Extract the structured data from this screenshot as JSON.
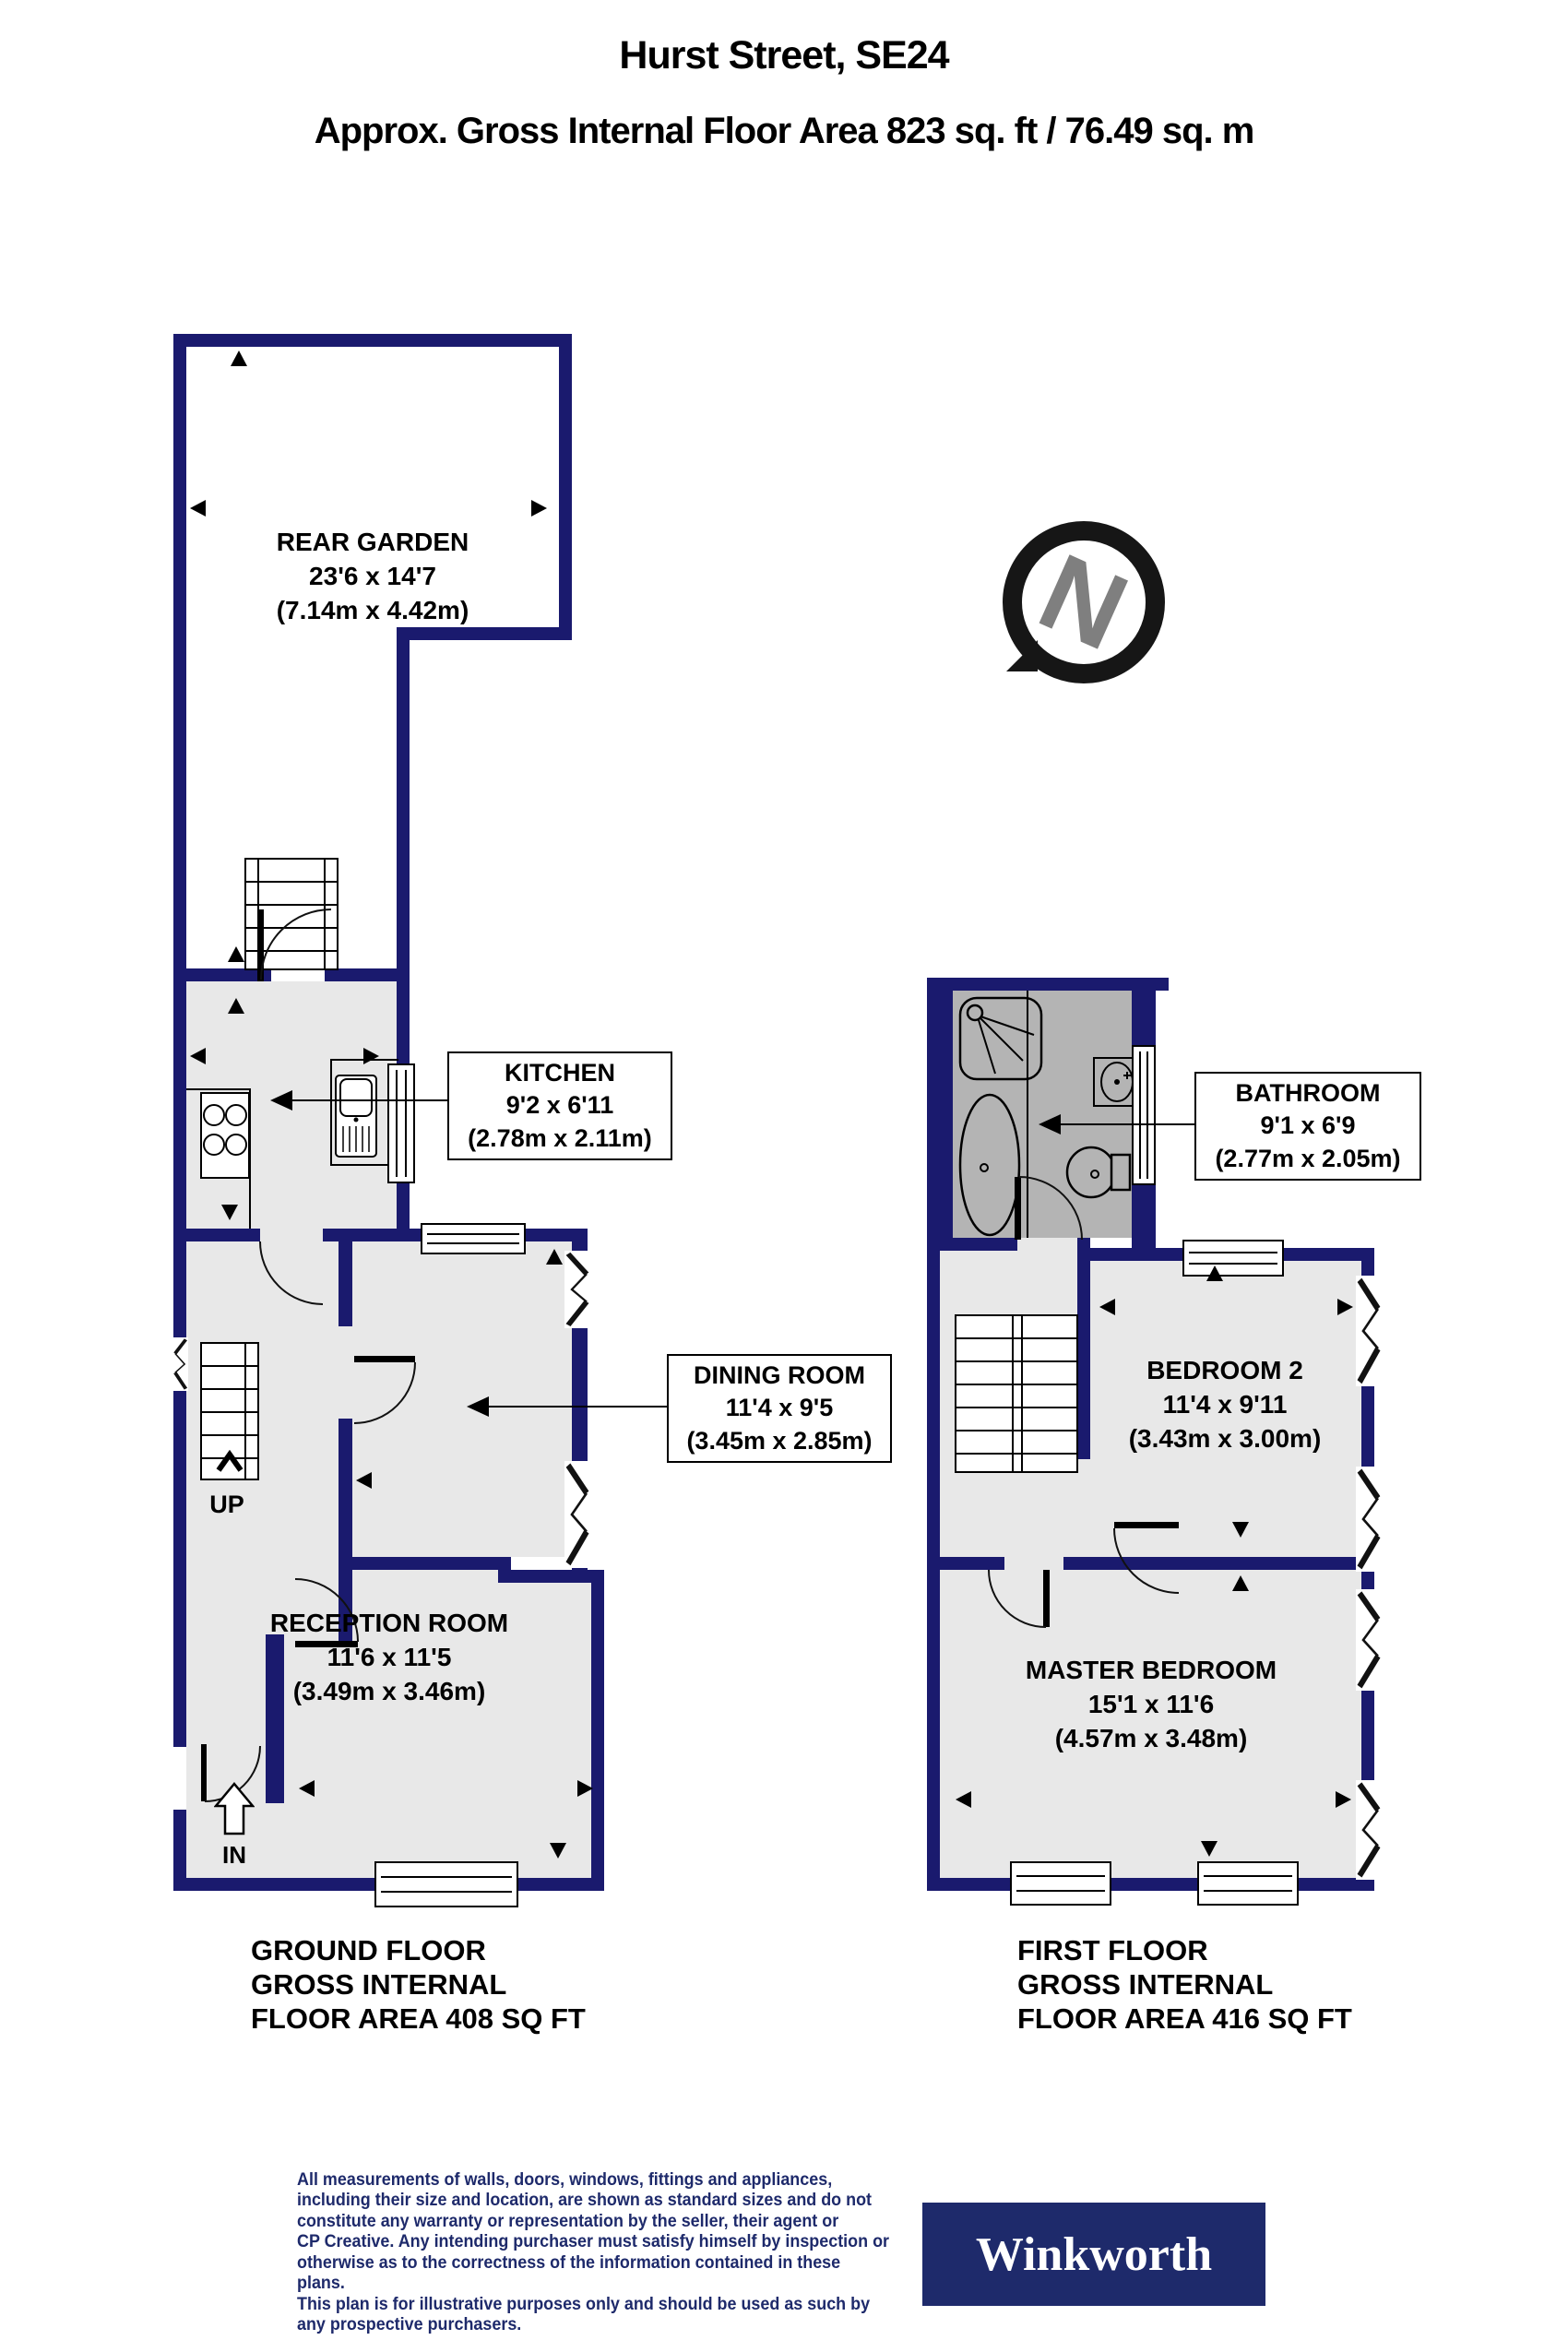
{
  "header": {
    "title": "Hurst Street, SE24",
    "subtitle": "Approx. Gross Internal Floor Area 823 sq. ft / 76.49 sq. m"
  },
  "colors": {
    "wall_navy": "#1a1a6e",
    "floor_light_gray": "#e8e8e8",
    "bathroom_gray": "#b4b4b4",
    "brand_navy": "#1e2a6b",
    "compass_letter_gray": "#7f7f7f"
  },
  "compass": {
    "letter": "N"
  },
  "ground_floor": {
    "garden_label": "REAR GARDEN\n23'6 x 14'7\n(7.14m x 4.42m)",
    "kitchen_label": "KITCHEN\n9'2 x 6'11\n(2.78m x 2.11m)",
    "dining_label": "DINING ROOM\n11'4 x 9'5\n(3.45m x 2.85m)",
    "reception_label": "RECEPTION ROOM\n11'6 x 11'5\n(3.49m x 3.46m)",
    "stairs_label": "UP",
    "entrance_label": "IN",
    "caption": "GROUND FLOOR\nGROSS INTERNAL\nFLOOR AREA 408 SQ FT"
  },
  "first_floor": {
    "bathroom_label": "BATHROOM\n9'1 x 6'9\n(2.77m x 2.05m)",
    "bedroom2_label": "BEDROOM 2\n11'4 x 9'11\n(3.43m x 3.00m)",
    "master_label": "MASTER BEDROOM\n15'1 x 11'6\n(4.57m x 3.48m)",
    "caption": "FIRST FLOOR\nGROSS INTERNAL\nFLOOR AREA 416 SQ FT"
  },
  "footer": {
    "disclaimer": "All measurements of walls, doors, windows, fittings and appliances,\nincluding their size and location, are shown as standard sizes and do not\nconstitute any warranty or representation by the seller, their agent or\nCP Creative. Any intending purchaser must satisfy himself by inspection or\notherwise as to the correctness of the information contained in these plans.\nThis plan is for illustrative purposes only and should be used as such by\nany prospective purchasers.",
    "brand": "Winkworth"
  }
}
